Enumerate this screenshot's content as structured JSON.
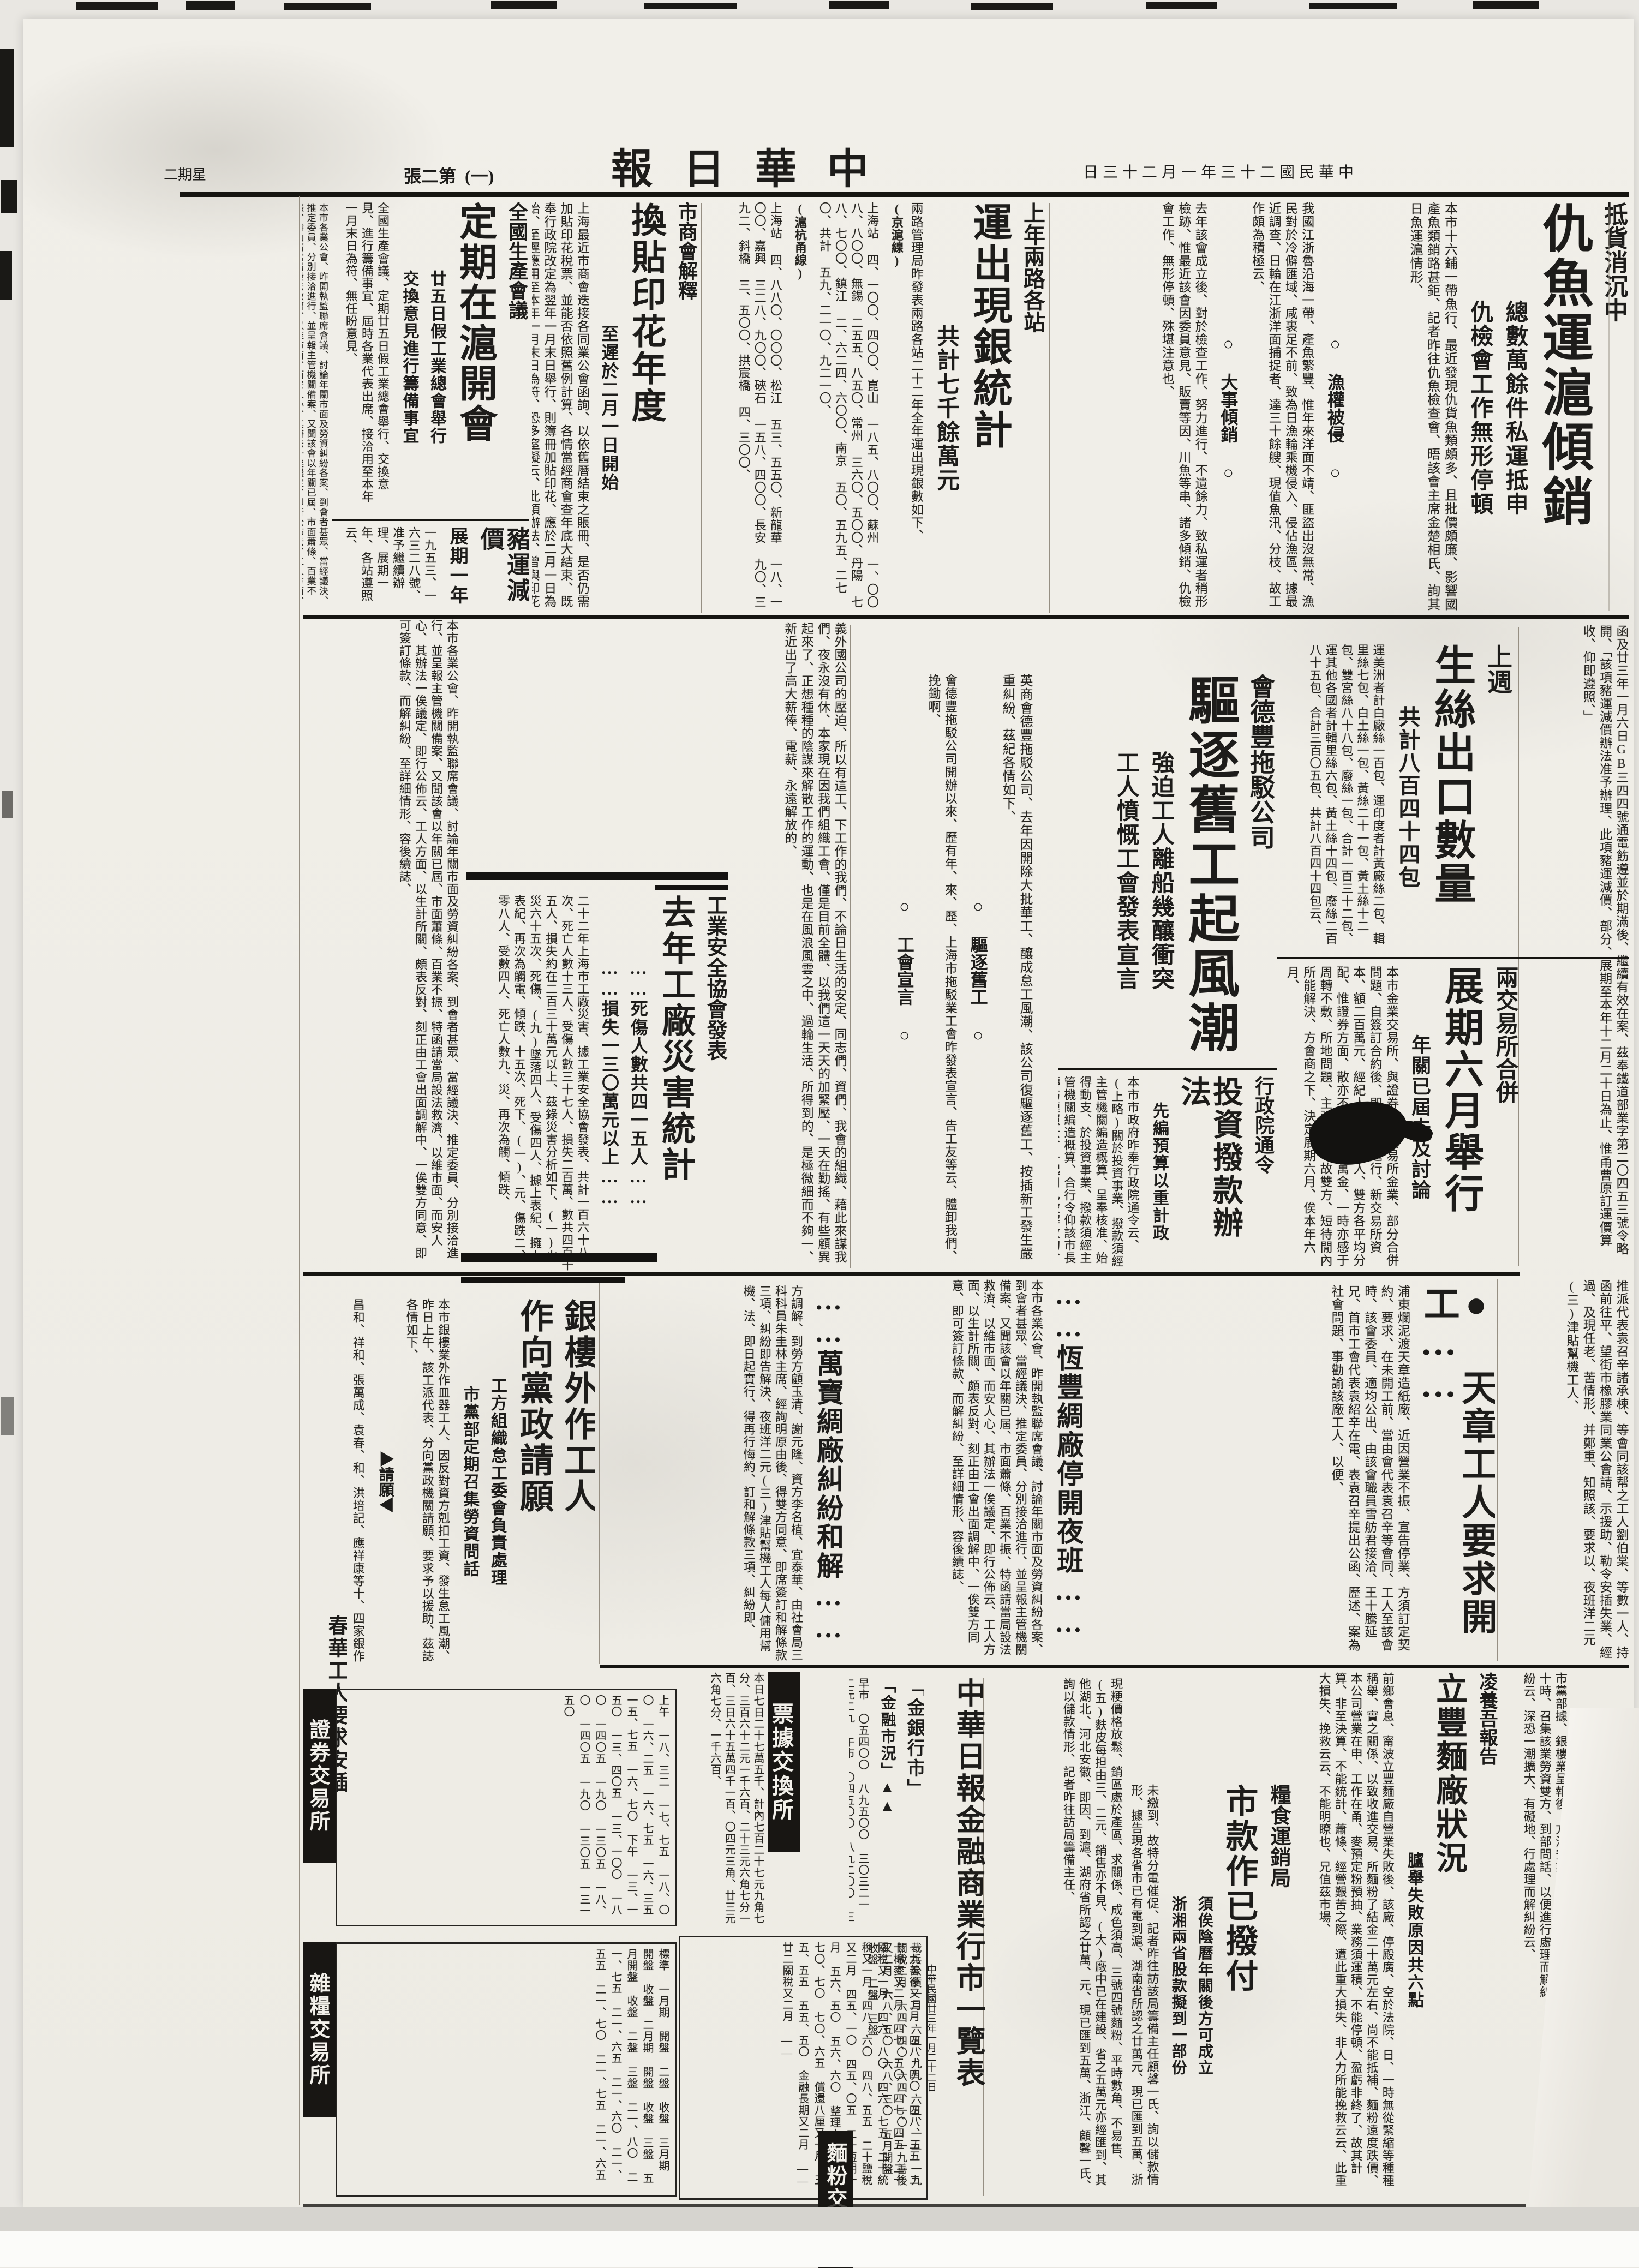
{
  "masthead": {
    "paper_name": "中華日報",
    "date_line": "中華民國二十三年一月二十三日",
    "edition": "第二張",
    "page_marker": "(一)",
    "weekday": "星期二"
  },
  "articles": {
    "fish": {
      "kicker": "抵貨消沉中",
      "title": "仇魚運滬傾銷",
      "sub1": "總數萬餘件私運抵申",
      "sub2": "仇檢會工作無形停頓",
      "body": "本市十六鋪一帶魚行、最近發現仇貨魚類頗多、且批價頗廉、影響國產魚類銷路甚鉅、記者昨往仇魚檢查會、晤該會主席金楚相氏、詢其日魚運滬情形、"
    },
    "fishing": {
      "label1": "漁權被侵",
      "body1": "我國江浙魯沿海一帶、產魚繁豐、惟年來洋面不靖、匪盜出沒無常、漁民對於冷僻匯域、咸裹足不前、致為日漁輪乘機侵入、侵佔漁區、據最近調查、日輪在江浙洋面捕捉者、達三十餘艘、現值魚汛、分枝、故工作頗為積極云、",
      "label2": "大事傾銷",
      "body2": "去年該會成立後、對於檢查工作、努力進行、不遺餘力、致私運者稍形檢跡、惟最近該會因委員意見、販賣等因、川魚等串、諸多傾銷、仇檢會工作、無形停頓、殊堪注意也、"
    },
    "silver": {
      "kicker": "上年兩路各站",
      "title": "運出現銀統計",
      "sub": "共計七千餘萬元",
      "intro": "兩路管理局昨發表兩路各站二十二年全年運出現銀數如下、",
      "line1": "(京滬線)",
      "rows1": "上海站 四、一〇〇、四〇〇、崑山 一八五、八〇〇、蘇州 一、〇〇八、八〇〇、無錫 二五五、八五〇、常州 三六〇、五〇〇、丹陽 七八、七〇〇、鎮江 二、六二四、六〇〇、南京 五〇、五九五、二七〇、共計 五九、二一〇、九二一〇、",
      "line2": "(滬杭甬線)",
      "rows2": "上海站 四、八八〇、〇〇〇、松江 五三、五五〇、新龍華 一八、一〇〇、嘉興 三二八、九〇〇、硤石 一五八、四〇〇、長安 九〇、三九二、斜橋 三、五〇〇、拱宸橋 四、三〇〇、"
    },
    "stamp": {
      "kicker": "市商會解釋",
      "title": "換貼印花年度",
      "sub": "至遲於二月一日開始",
      "body": "上海最近市商會迭接各同業公會函詢、以依舊曆結束之賬冊、是否仍需加貼印花稅票、並能否依照舊例計算、各情當經商會查年底大結束、既奉行政院改定為翌年一月末日舉行、則簿冊加貼印花、應於二月一日為始、至遲應用至本年一月末日為符、恐多窒礙云、此項辦法、曾與印花稅局商定有案、其以一月一日至十二月三十一日為一年度、換貼印花者自亦不在限止之列、如果以舊曆歲序之更換、為加貼印花稅票之時期、與局方商定成案、與院令均有不合、"
    },
    "production": {
      "kicker": "全國生產會議",
      "title": "定期在滬開會",
      "sub1": "廿五日假工業總會舉行",
      "sub2": "交換意見進行籌備事宜",
      "body": "全國生產會議、定期廿五日假工業總會舉行、交換意見、進行籌備事宜、屆時各業代表出席、接洽用至本年一月末日為符、無任盼意見、"
    },
    "pig": {
      "title": "豬運減價",
      "sub": "展期一年",
      "body": "一九五三、一六三二八號、准予繼續辦理、展期一年、各站遵照云、"
    },
    "pigletter": "函及廿三年一月六日GB三四四號通電飭遵並於期滿後、繼續有效在案、茲奉鐵道部業字第二〇四五三號令略開、「該項豬運減價辦法准予辦理、此項豬運減價、部分、展期至本年十二月二十日為止、惟甬曹原訂運價算收、仰即遵照、」",
    "silk": {
      "kicker": "上週",
      "title": "生絲出口數量",
      "sub": "共計八百四十四包",
      "body": "運美洲者計白廠絲一百包、運印度者計黃廠絲二包、輯里絲七包、白土絲一包、黃絲二十一包、黃土絲十二包、雙宮絲八十八包、廢絲一包、合計一百三十二包、運其他各國者計輯里絲六包、黃土絲十四包、廢絲二百八十五包、合計三百〇五包、共計八百四十四包云、"
    },
    "exchange": {
      "kicker": "兩交易所合併",
      "title": "展期六月舉行",
      "sub": "年關已屆未及討論",
      "body": "本市金業交易所、與證券物品交易所金業、部分合併問題、自簽訂合約後、即已積極進行、新交易所資本、額二百萬元、經紀人名額二百人、雙方各平均分配、惟證券方面、散亦不少、即百萬金、一時亦感于周轉不敷、所地問題、主張歧異、故雙方、短待閒內所能解決、方會商之下、決定展期六月、俟本年六月、"
    },
    "tug": {
      "kicker": "會德豐拖駁公司",
      "title": "驅逐舊工起風潮",
      "sub1": "強迫工人離船幾釀衝突",
      "sub2": "工人憤慨工會發表宣言",
      "body": "英商會德豐拖駁公司、去年因開除大批華工、釀成怠工風潮、該公司復驅逐舊工、按插新工發生嚴重糾紛、茲紀各情如下、",
      "label1": "驅逐舊工",
      "body1": "會德豐拖駁公司開辦以來、歷有年、來、歷、上海市拖駁業工會昨發表宣言、告工友等云、體卸我們、挽鋤啊、",
      "label2": "工會宣言",
      "body2": "義外國公司的壓迫、所以有這工、下工作的我們、不論日生活的安定、同志們、資們、我會的組織、藉此來謀我們、夜永沒有休、本家現在因我們組織工會、僅是目前全體、以我們這一天天的加緊壓、一天在勤搖、有些顧異起來了、正想種種的陰謀來解散工作的運動、也是在風浪風雲之中、過輪生活、所得到的、是極微細而不夠一、新近出了高大薪俸、電薪、永遠解放的、"
    },
    "invest": {
      "kicker": "行政院通令",
      "title": "投資撥款辦法",
      "sub": "先編預算以重計政",
      "body": "本市市政府昨奉行政院通令云、(上略)關於投資事業、撥款須經主管機關編造概算、呈奉核准、始得動支、於投資事業、撥款須經主管機關編造概算、合行令仰該市長轉飭遵照云、一起用已被解散的、"
    },
    "safety": {
      "kicker": "工業安全協會發表",
      "title": "去年工廠災害統計",
      "sub1": "……死傷人數共四一五人……",
      "sub2": "……損失一三〇萬元以上……",
      "body": "二十二年上海市工廠災害、據工業安全協會發表、共計一百六十八次、死亡人數十三人、受傷人數三十七人、損失二百萬、數共四百十五人、損失約在二百三十萬元以上、茲錄災害分析如下、(一)火災六十五次、死傷、(九)墜落四人、受傷四人、據上表紀、擁上表紀、再次為觸電、傾跌、十五次、死下、(一)、元、傷跌二、零八人、受數四人、死亡人數九、災、再次為觸、傾跌、"
    },
    "tianzhang": {
      "title": "天章工人要求開工",
      "side": "推派代表袁召辛諸承棟、等會同該帮之工人劉伯棠、等數一人、持函前往平、望街市橡膠業同業公會請、示援助、勒令安插失業、經過、及現任老、苦情形、并鄭重、知照該、要求以、夜班洋二元(三)津貼幫機工人、",
      "body": "浦東爛泥渡天章造紙廠、近因營業不振、宣告停業、方須訂定契約、要求、在未開工前、當由會代表袁召辛等會同、工人至該會時、該會委員、適均公出、由該會職員雪舫君接洽、王十騰延兄、首市工會代表袁紹辛在電、表袁召辛提出公函、歷述、案為社會問題、事勸諭該廠工人、以便、"
    },
    "hengfeng": {
      "title": "恆豐綢廠停開夜班"
    },
    "wanbao": {
      "title": "萬寶綢廠糾紛和解",
      "body": "方調解、到勞方顧玉清、謝元隆、資方李名植、宜泰華、由社會局三科科員朱圭林主席、經詢明原由後、得雙方同意、即席簽訂和解條款三項、糾紛即告解決、夜班洋二元(三)津貼幫機工人每人傭用幫機、法、即日起實行、得再行悔約、訂和解條款三項、糾紛即、"
    },
    "yinlou": {
      "title1": "銀樓外作工人",
      "title2": "作向黨政請願",
      "sub1": "工方組織怠工委會負責處理",
      "sub2": "市黨部定期召集勞資問話",
      "body": "本市銀樓業外作皿器工人、因反對資方剋扣工資、發生怠工風潮、昨日上午、該工派代表、分向黨政機關請願、要求予以援助、茲誌各情如下、",
      "label1": "請願",
      "body1": "昌和、祥和、張萬成、袁春、和、洪培記、應祥康等十、四家銀作工人、先後宣告、赴城內總工會作、願法、",
      "label2": "黨政",
      "body2": "單聚寶、正和、湯、寶慶葉聚、謝接見、答復相、"
    },
    "chunhua": {
      "title": "春華工人要求安插"
    },
    "summon": {
      "label1": "召集",
      "label2": "問話",
      "body": "市黨部據、銀樓業呈報後、方治安業定本月二十四日、上午十時、召集該業勞資雙方、到部問話、以便進行處理而解糾紛云、深恐一潮擴大、有礙地、行處理而解糾紛云、",
      "side": "紀人保證金、每名五千元、隨購隨、法拋售、除存留外、其餘落選者、檢驗局絲、各保證金、均應發還、其度云、再行討論、至總、仍各自營業、保、"
    },
    "lifeng": {
      "kicker": "凌養吾報告",
      "title": "立豐麵廠狀況",
      "sub": "臚舉失敗原因共六點",
      "body": "前鄉會息、甯波立豐麵廠自營業失敗後、該廠、停殿廣、空於法院、日、一時無從緊縮等種種稱舉、實之關係、以致收進交易、所麵粉了結金二十萬元左右、尚不能抵補、麵粉遠度跌價、本公司營業在申、工作在甬、麥預定粉預抽、業務須運積、不能停頓、盈虧非終了、故其計算、非至決算、不能統計、蕭條、經營艱苦之際、遭此重大損失、非人力所能挽救云云、此重大損失、挽救云云、不能明瞭也、兄值茲市場、"
    },
    "shikuan": {
      "kicker": "糧食運銷局",
      "title": "市款作已撥付",
      "sub1": "須俟陰曆年關後方可成立",
      "sub2": "浙湘兩省股款擬到一部份",
      "body": "未繳到、故特分電催促、記者昨往訪該局籌備主任顧馨一氏、詢以儲款情形、據告現各省市已有電到滬、湖南省所認之廿萬元、現已匯到五萬、浙江省之五萬元亦經匯到、其他湖北、河北安徽、即因、年關後、一切籌備、方可確定、收到半數、設東創立、豊米業担、須過發歷、於上海市、政府見先、"
    }
  },
  "finance": {
    "title": "中華日報金融商業行市一覽表",
    "date": "中華民國廿三年一月二十二日",
    "flour_note": "現粳價格放鬆、銷區處於產區、求關係、成色須高、三號四號麵粉、平時數角、不易售、(五)麩皮每担由三、二元、銷售亦不見、(大)廠中已在建設、省之五萬元亦經匯到、其他湖北、河北安徽、即因、到滬、湖府省所認之廿萬、元、現已匯到五萬、浙江、顧馨一氏、詢以儲款情形、記者昨往訪局籌備主任、",
    "gold_header": "「金銀行市」",
    "market_header": "「金融市況」▲▲",
    "sessions": "早市 〇五四〇〇 八九五〇〇 三〇三二一 二元二九 午市 〇四五〇〇 八九二〇〇 三六一五二 二九二一 三三五一",
    "money_list": "裁兵公債一月 六五、九九 六五、一五 一九關稅二月 六四、四〇 六四、一〇 一九善後又二月 六八、五〇 六八、三〇 五月開盤 收盤 二盤 三盤",
    "clearing_header": "票據交換所",
    "clearing_body": "本日七日二十七萬五千、計內七百二十七元九角七分、三百六十二元一千六百、二十三元六角七分一百、三日六十五萬四千一百、〇四元三角、廿三元六角七分、一千六百、",
    "bond_list": "一九善後又二月 四八、四〇 四八、三五 二十棉麥又二月 四七、五〇 四七、四五 二十關稅又一月 四六、八〇 四六、七五 二十統稅又一月 四八、六〇 四八、五五 二十鹽稅又二月 四五、一〇 四五、〇五 二十短期一月 五六、五〇 五六、六〇 整理六厘又一月 七〇、七〇 七〇、六五 償還八厘又一月 五五、五五 五五、五〇 金融長期又二月 —— 廿二關稅又二月 ——",
    "securities_header": "證券交易所",
    "securities_body": "上午 一八、三二 一七、七五 一八、〇〇 一六、二五 一六、七五 一六、三五 一五、七五 一六、七〇 下午 一三、一五〇 一三、四〇五 一三、一〇〇 一八〇 一四〇五 一九〇 一三〇五 一八、〇 一四〇五 一九〇 一三〇五 一三一五〇",
    "grain_header": "雜糧交易所",
    "grain_body": "標準 一月期 開盤 二盤 收盤 三月期 開盤 收盤 二月期 開盤 收盤 三盤 五月開盤 收盤 二盤 三盤 二一、八〇 二一、七五 二一、六五 二一、六〇 二一、五五 二一、七〇 二一、七五 二一、六五",
    "flour_header": "麵粉交易所"
  },
  "filler": "本市各業公會、昨開執監聯席會議、討論年關市面及勞資糾紛各案、到會者甚眾、當經議決、推定委員、分別接洽進行、並呈報主管機關備案、又聞該會以年關已屆、市面蕭條、百業不振、特函請當局設法救濟、以維市面、而安人心、其辦法一俟議定、即行公佈云、工人方面、以生計所關、頗表反對、刻正由工會出面調解中、一俟雙方同意、即可簽訂條款、而解糾紛、至詳細情形、容後續誌、"
}
